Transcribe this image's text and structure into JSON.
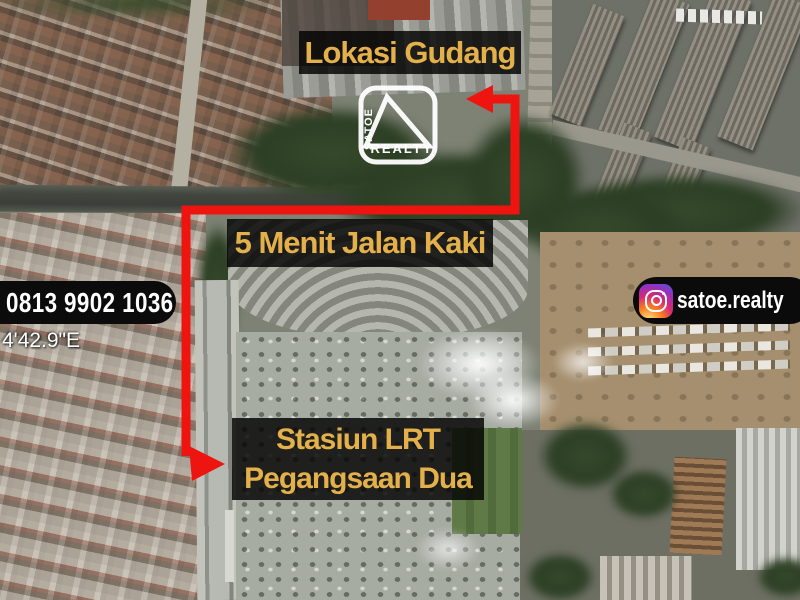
{
  "colors": {
    "accent_gold": "#E4B04A",
    "route_red": "#EE1510",
    "pill_black": "#0B0B0B",
    "text_white": "#FFFFFF"
  },
  "annotations": {
    "location_label": "Lokasi Gudang",
    "walk_label": "5 Menit Jalan Kaki",
    "station_line1": "Stasiun LRT",
    "station_line2": "Pegangsaan Dua"
  },
  "contact": {
    "phone": "0813 9902 1036",
    "instagram_handle": "satoe.realty",
    "instagram_icon": "instagram-gradient-camera"
  },
  "logo": {
    "brand_vertical": "SATOE",
    "brand_bottom": "REALTY",
    "icon": "triangle-roof-outline"
  },
  "map": {
    "type": "satellite-photo",
    "coordinate_fragment": "4'42.9\"E"
  }
}
